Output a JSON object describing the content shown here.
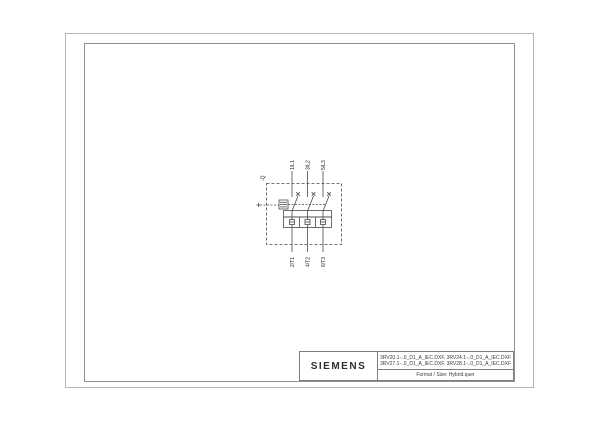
{
  "page": {
    "background": "#ffffff",
    "outer_border_color": "#b5b5b5",
    "frame_color": "#909090"
  },
  "schematic": {
    "device_tag": "-Q",
    "line_color": "#4a4a4a",
    "text_color": "#1a1a1a",
    "top_terminals": [
      "1/L1",
      "3/L2",
      "5/L3"
    ],
    "bottom_terminals": [
      "2/T1",
      "4/T2",
      "6/T3"
    ]
  },
  "title_block": {
    "brand": "SIEMENS",
    "file_names_line1": "3RV20.1-..0_D1_A_IEC.DXF, 3RV24.1-..0_D1_A_IEC.DXF",
    "file_names_line2": "3RV27.1-..0_D1_A_IEC.DXF, 3RV28.1-..0_D1_A_IEC.DXF",
    "format_label": "Format / Size: Hybrid.quer"
  }
}
